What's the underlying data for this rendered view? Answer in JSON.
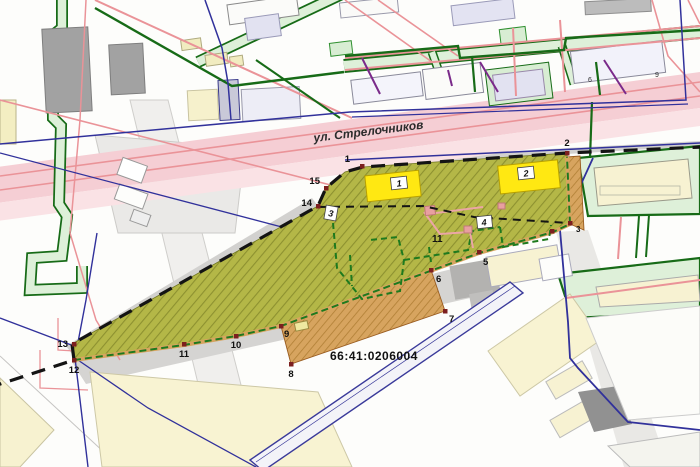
{
  "street": {
    "label": "ул. Стрелочников"
  },
  "cadastral": {
    "number": "66:41:0206004"
  },
  "parcel": {
    "area_label": "11",
    "vertices": [
      {
        "label": "1"
      },
      {
        "label": "2"
      },
      {
        "label": "3"
      },
      {
        "label": "5"
      },
      {
        "label": "6"
      },
      {
        "label": "7"
      },
      {
        "label": "8"
      },
      {
        "label": "9"
      },
      {
        "label": "10"
      },
      {
        "label": "11"
      },
      {
        "label": "12"
      },
      {
        "label": "13"
      },
      {
        "label": "14"
      },
      {
        "label": "15"
      }
    ],
    "contours": [
      {
        "label": "1"
      },
      {
        "label": "2"
      },
      {
        "label": "3"
      },
      {
        "label": "4"
      }
    ]
  },
  "buildings": {
    "floor_labels": [
      {
        "label": "9"
      },
      {
        "label": "6"
      }
    ]
  },
  "colors": {
    "parcel_fill": "#b4b747",
    "parcel_hatch": "#8d9130",
    "strip_fill": "#d7a45f",
    "highlight_building": "#ffe812",
    "boundary_dash": "#141414",
    "vertex_dot": "#7c1f1f",
    "street_pink": "#f5ced4",
    "utility_red": "#ea9398",
    "utility_green": "#176b17",
    "utility_navy": "#31319b",
    "corridor_fill": "#def0d9",
    "building_gray": "#a2a2a2",
    "building_cream": "#f7f2d2",
    "building_lavender": "#e2e2f1"
  }
}
